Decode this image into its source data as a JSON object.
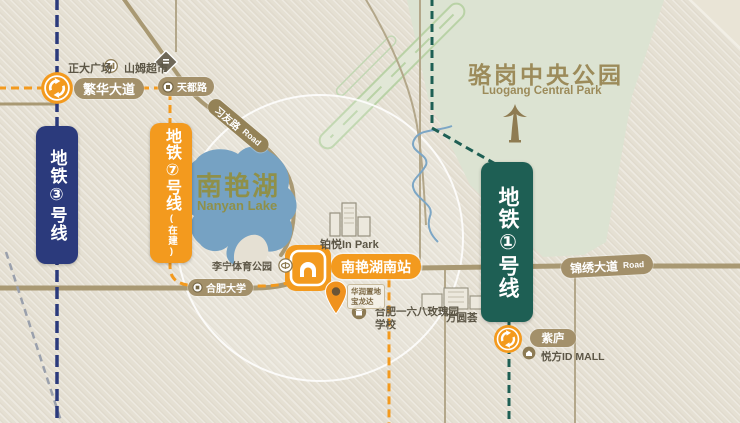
{
  "banners": {
    "line3": {
      "label": "地铁③号线"
    },
    "line7": {
      "label": "地铁⑦号线",
      "sub": "(在建)"
    },
    "line1": {
      "label": "地铁①号线"
    }
  },
  "park": {
    "title": "骆岗中央公园",
    "subtitle": "Luogang Central Park"
  },
  "lake": {
    "title": "南艳湖",
    "subtitle": "Nanyan Lake"
  },
  "roads": {
    "fanhua_avenue": "繁华大道",
    "tiandu_road": "天都路",
    "xiyou_road": "习友路",
    "xiyou_road_en": "Road",
    "jinxiu_avenue": "锦绣大道",
    "jinxiu_avenue_en": "Road",
    "hefei_university": "合肥大学"
  },
  "stations": {
    "nanyanhu_south": "南艳湖南站",
    "zilu": "紫庐"
  },
  "pois": {
    "zhengda_plaza": "正大广场",
    "sams_club": "山姆超市",
    "lining_sports_park": "李宁体育公园",
    "boyue_in_park": "铂悦In Park",
    "school_line1": "合肥一六八玫瑰园",
    "school_line2": "学校",
    "fangyuanhui": "方圆荟",
    "yuefang_id_mall": "悦方ID MALL",
    "project_line1": "华润置地",
    "project_line2": "宝龙达"
  },
  "colors": {
    "background": "#e5e0d3",
    "park_green": "#dde3d3",
    "lake_blue": "#76a2c3",
    "road_tan": "#a3906a",
    "line3_blue": "#2b3a7c",
    "line7_orange": "#f39a1e",
    "line1_teal": "#1e5f54"
  }
}
